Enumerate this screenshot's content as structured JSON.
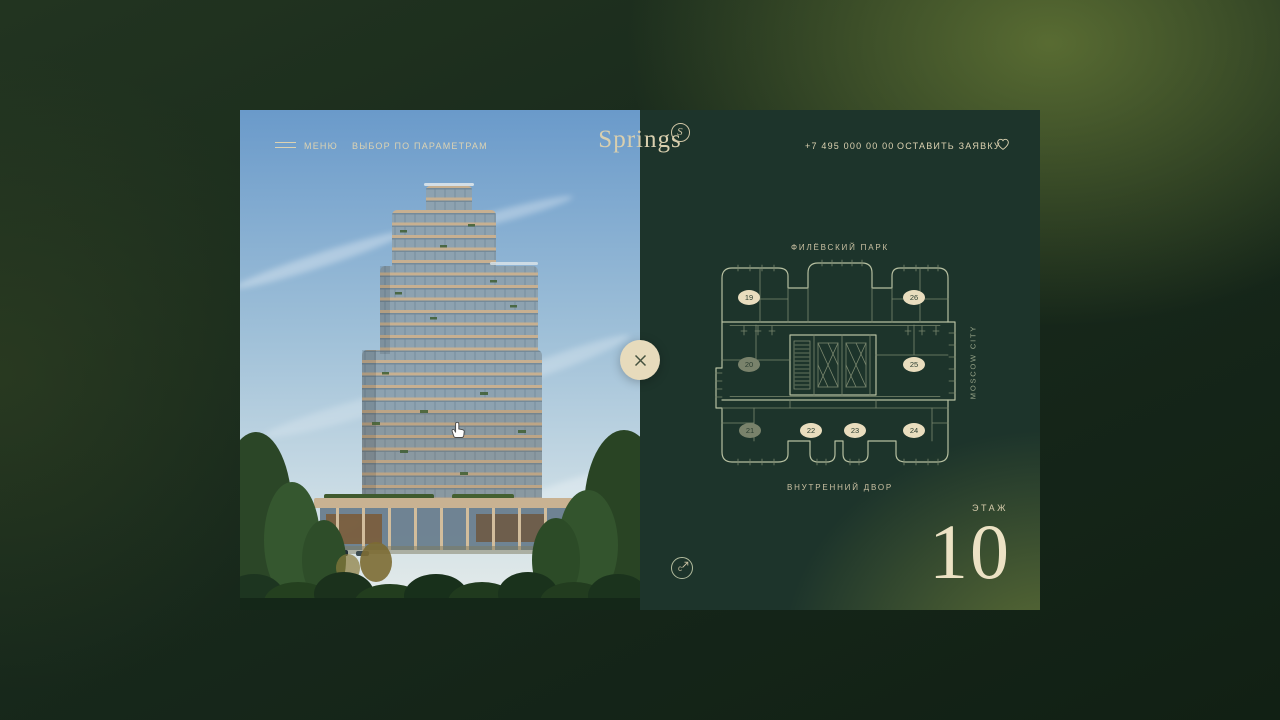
{
  "theme": {
    "page-bg": "#15261b",
    "page-glow": "#5e7134",
    "panel-bg": "#1d342b",
    "panel-glow": "#607136",
    "cream": "#ddd3b2",
    "cream-bright": "#ece2c4",
    "plan-line": "#b6bfa0",
    "plan-line-dim": "#7b886f",
    "badge-bg": "#e9ddbe",
    "badge-muted-bg": "#79826b",
    "badge-text": "#2b3d30",
    "sky-top": "#6a9aca",
    "sky-bottom": "#e6ecea"
  },
  "header": {
    "menu": "МЕНЮ",
    "filter": "ВЫБОР ПО ПАРАМЕТРАМ",
    "logo": "Springs",
    "monogram": "S",
    "phone": "+7 495 000 00 00",
    "cta": "ОСТАВИТЬ ЗАЯВКУ"
  },
  "plan": {
    "park_label": "ФИЛЁВСКИЙ ПАРК",
    "yard_label": "ВНУТРЕННИЙ ДВОР",
    "city_label": "MOSCOW CITY",
    "floor_label": "ЭТАЖ",
    "floor_number": "10",
    "compass_letter": "с",
    "apartments": [
      {
        "number": "19",
        "state": "available",
        "x": 109,
        "y": 188
      },
      {
        "number": "26",
        "state": "available",
        "x": 274,
        "y": 188
      },
      {
        "number": "20",
        "state": "muted",
        "x": 109,
        "y": 255
      },
      {
        "number": "25",
        "state": "available",
        "x": 274,
        "y": 255
      },
      {
        "number": "21",
        "state": "muted",
        "x": 110,
        "y": 321
      },
      {
        "number": "22",
        "state": "available",
        "x": 171,
        "y": 321
      },
      {
        "number": "23",
        "state": "available",
        "x": 215,
        "y": 321
      },
      {
        "number": "24",
        "state": "available",
        "x": 274,
        "y": 321
      }
    ]
  }
}
